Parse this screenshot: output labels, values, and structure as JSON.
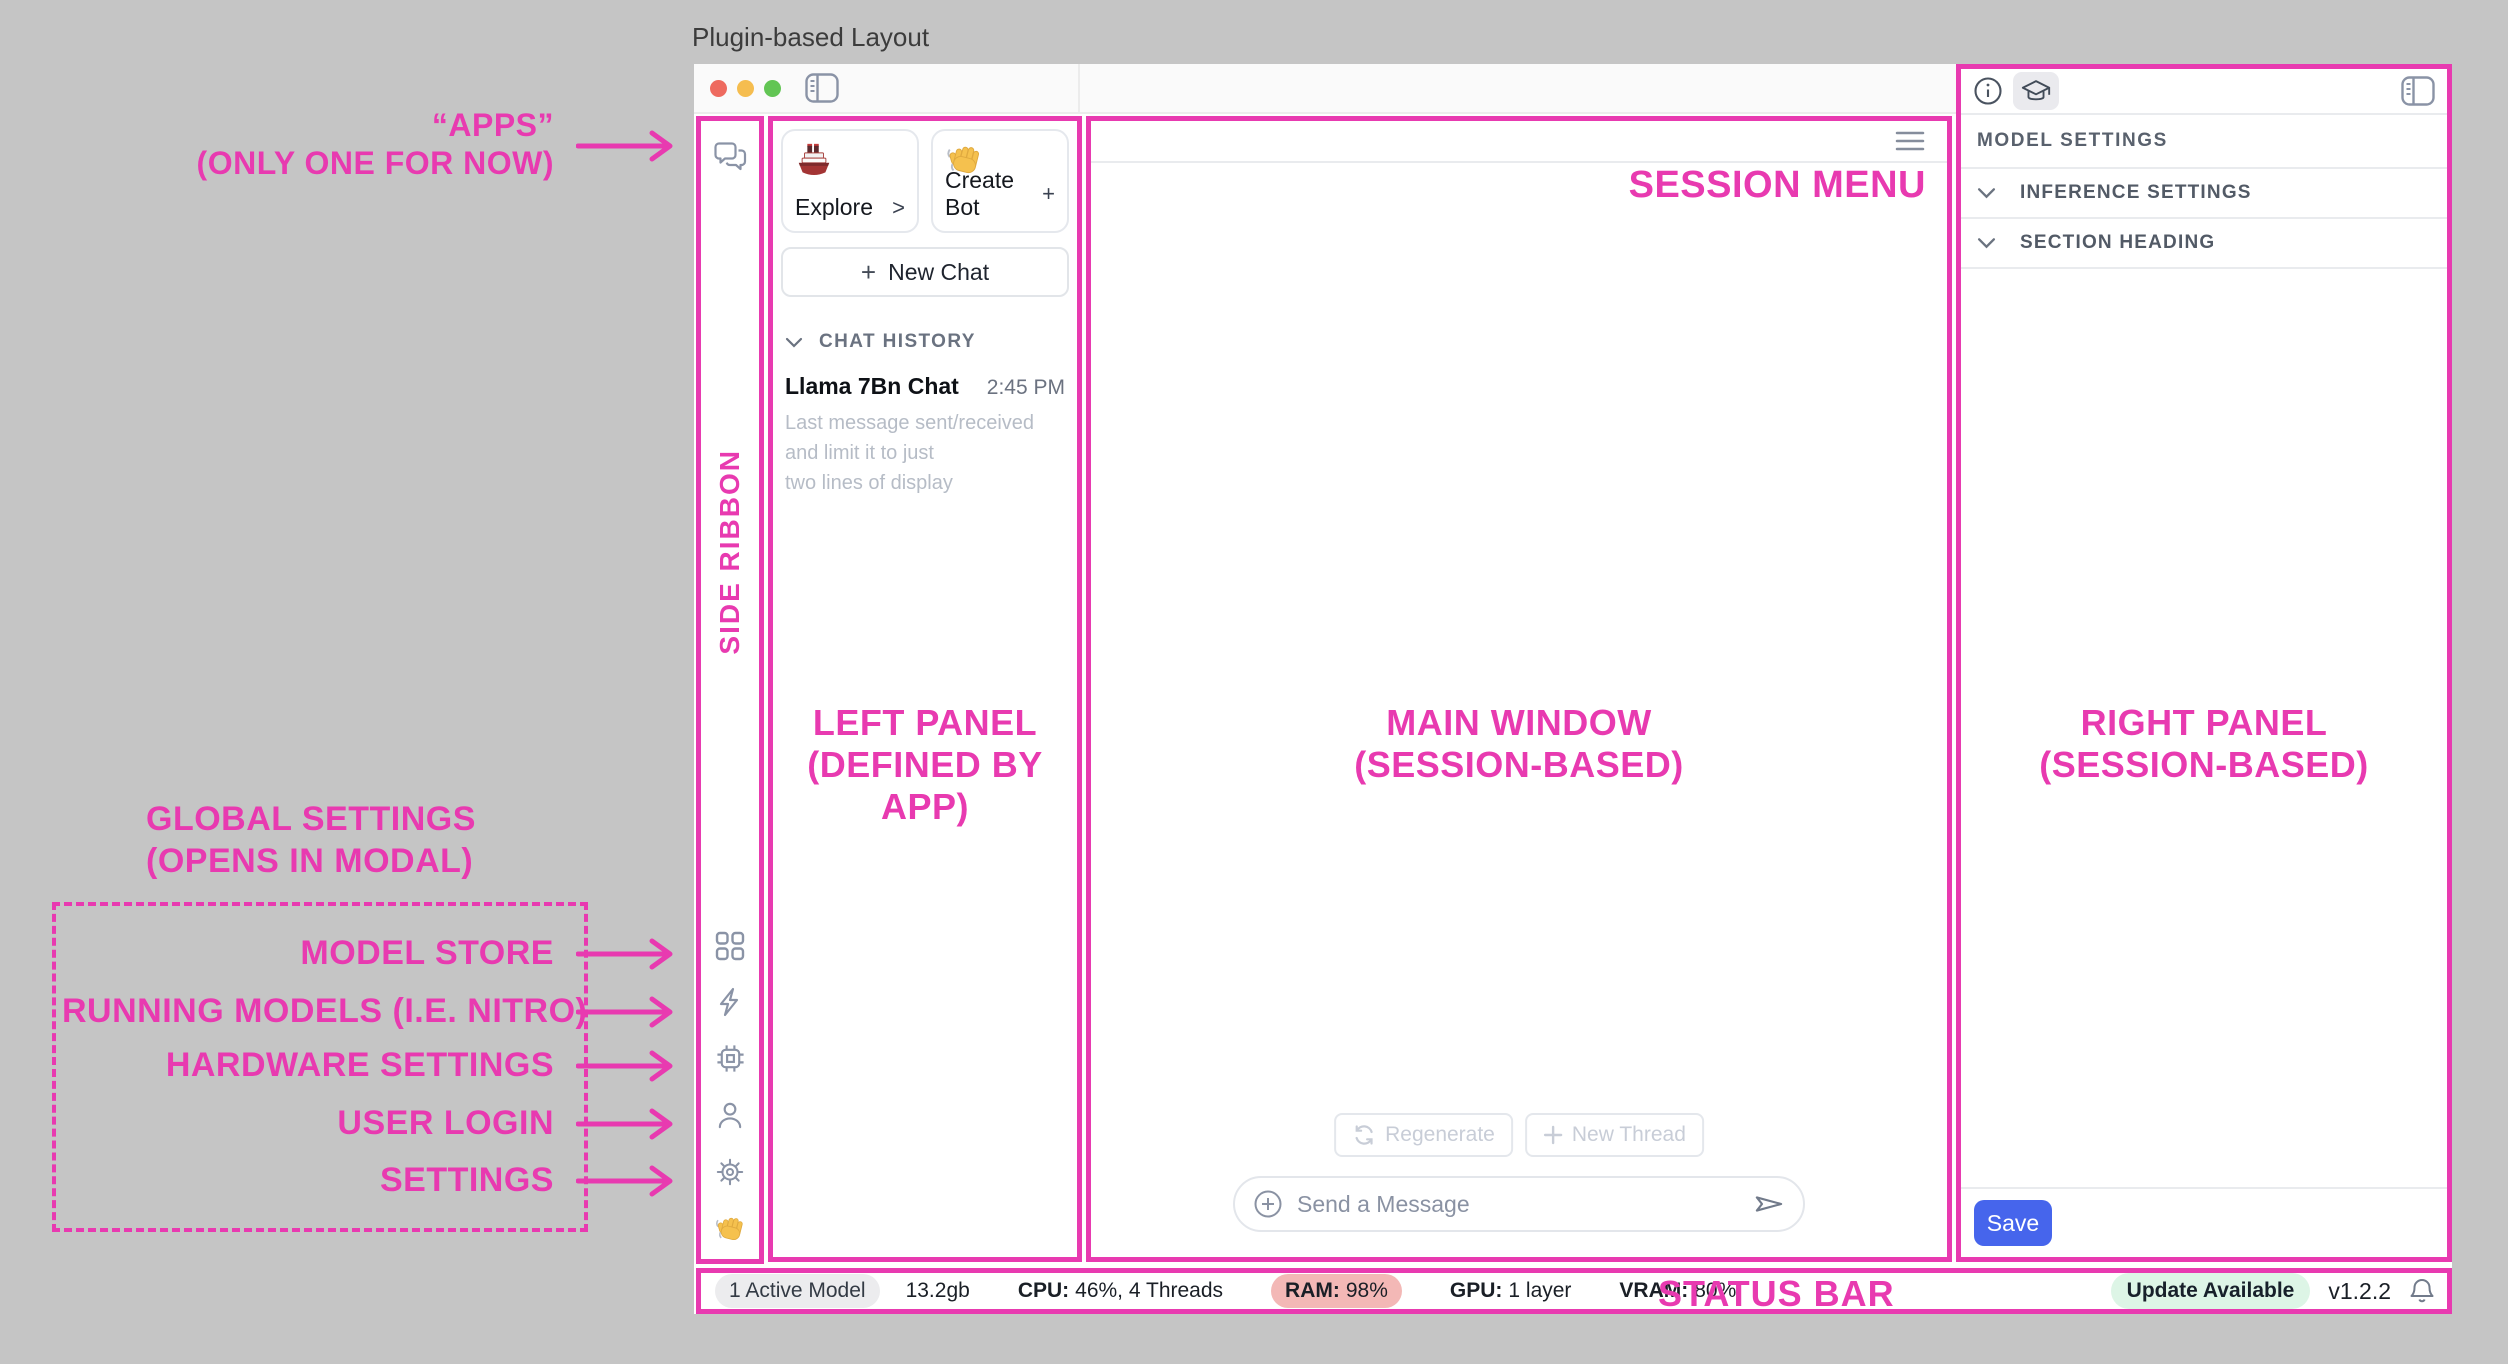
{
  "page": {
    "title": "Plugin-based Layout"
  },
  "colors": {
    "accent_pink": "#E83AB0",
    "save_blue": "#4665EC",
    "ram_badge_bg": "#F3B8B6",
    "update_badge_bg": "#DDF5E6",
    "traffic_red": "#EE6A5F",
    "traffic_yellow": "#F5BD4F",
    "traffic_green": "#62C554"
  },
  "annotations": {
    "apps_line1": "“APPS”",
    "apps_line2": "(ONLY ONE FOR NOW)",
    "side_ribbon": "SIDE RIBBON",
    "session_menu": "SESSION MENU",
    "left_panel_line1": "LEFT PANEL",
    "left_panel_line2": "(DEFINED BY APP)",
    "main_window_line1": "MAIN WINDOW",
    "main_window_line2": "(SESSION-BASED)",
    "right_panel_line1": "RIGHT PANEL",
    "right_panel_line2": "(SESSION-BASED)",
    "status_bar": "STATUS BAR",
    "global_settings_line1": "GLOBAL SETTINGS",
    "global_settings_line2": "(OPENS IN MODAL)",
    "global_items": [
      "MODEL STORE",
      "RUNNING MODELS (I.E. NITRO)",
      "HARDWARE SETTINGS",
      "USER LOGIN",
      "SETTINGS"
    ]
  },
  "left_panel": {
    "cards": [
      {
        "icon": "ship-emoji",
        "label": "Explore",
        "action": ">"
      },
      {
        "icon": "wave-emoji",
        "label": "Create Bot",
        "action": "+"
      }
    ],
    "new_chat_plus": "+",
    "new_chat_label": "New Chat",
    "chat_history_heading": "CHAT HISTORY",
    "chat_item": {
      "title": "Llama 7Bn Chat",
      "time": "2:45 PM",
      "preview_line1": "Last message sent/received and limit it to just",
      "preview_line2": "two lines of display"
    }
  },
  "main_window": {
    "regenerate_label": "Regenerate",
    "new_thread_label": "New Thread",
    "message_placeholder": "Send a Message"
  },
  "right_panel": {
    "heading": "MODEL SETTINGS",
    "sections": [
      {
        "label": "INFERENCE SETTINGS"
      },
      {
        "label": "SECTION HEADING"
      }
    ],
    "save_label": "Save"
  },
  "status_bar": {
    "active_model": "1 Active Model",
    "memory": "13.2gb",
    "cpu_label": "CPU:",
    "cpu_value": "46%, 4 Threads",
    "ram_label": "RAM:",
    "ram_value": "98%",
    "gpu_label": "GPU:",
    "gpu_value": "1 layer",
    "vram_label": "VRAM:",
    "vram_value": "80%",
    "update_badge": "Update Available",
    "version": "v1.2.2"
  },
  "icons": {
    "ribbon_top": "chat-bubbles",
    "ribbon_bottom": [
      "grid",
      "lightning",
      "cpu-chip",
      "user",
      "gear",
      "wave-hand"
    ],
    "titlebar": "sidebar-toggle",
    "main_top": "hamburger-menu",
    "right_header": [
      "info-circle",
      "graduation-cap",
      "sidebar-toggle"
    ],
    "composer": [
      "circle-plus",
      "send-plane"
    ],
    "status": "bell"
  }
}
